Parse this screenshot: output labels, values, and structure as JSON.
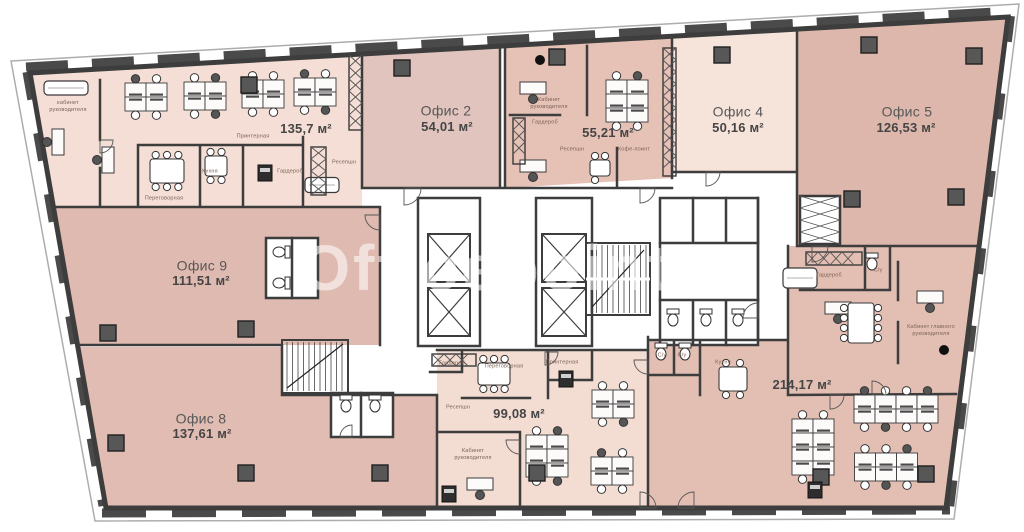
{
  "watermark": "Officepoints",
  "offices": {
    "o135": {
      "area": "135,7 м²"
    },
    "o2": {
      "name": "Офис 2",
      "area": "54,01 м²"
    },
    "o55": {
      "area": "55,21 м²"
    },
    "o4": {
      "name": "Офис 4",
      "area": "50,16 м²"
    },
    "o5": {
      "name": "Офис 5",
      "area": "126,53 м²"
    },
    "o9": {
      "name": "Офис 9",
      "area": "111,51 м²"
    },
    "o8": {
      "name": "Офис 8",
      "area": "137,61 м²"
    },
    "o99": {
      "area": "99,08 м²"
    },
    "o214": {
      "area": "214,17 м²"
    }
  },
  "rooms": {
    "cabinet_lc": "кабинет\nруководителя",
    "cabinet": "Кабинет\nруководителя",
    "cabinet_chief": "Кабинет главного\nруководителя",
    "meeting": "Переговорная",
    "kitchen": "Кухня",
    "printer": "Принтерная",
    "wardrobe": "Гардероб",
    "reception": "Ресепшн",
    "coffee": "Кофе-поинт",
    "wc": "С/у"
  },
  "colors": {
    "room_light": "#f5e1d8",
    "room_dusty": "#dfbab0",
    "room_dusty_dark": "#e3bfb3",
    "room_mauve": "#e0c4bd",
    "wall": "#3d3d3d",
    "column": "#575757",
    "window": "#4a4a4a"
  }
}
